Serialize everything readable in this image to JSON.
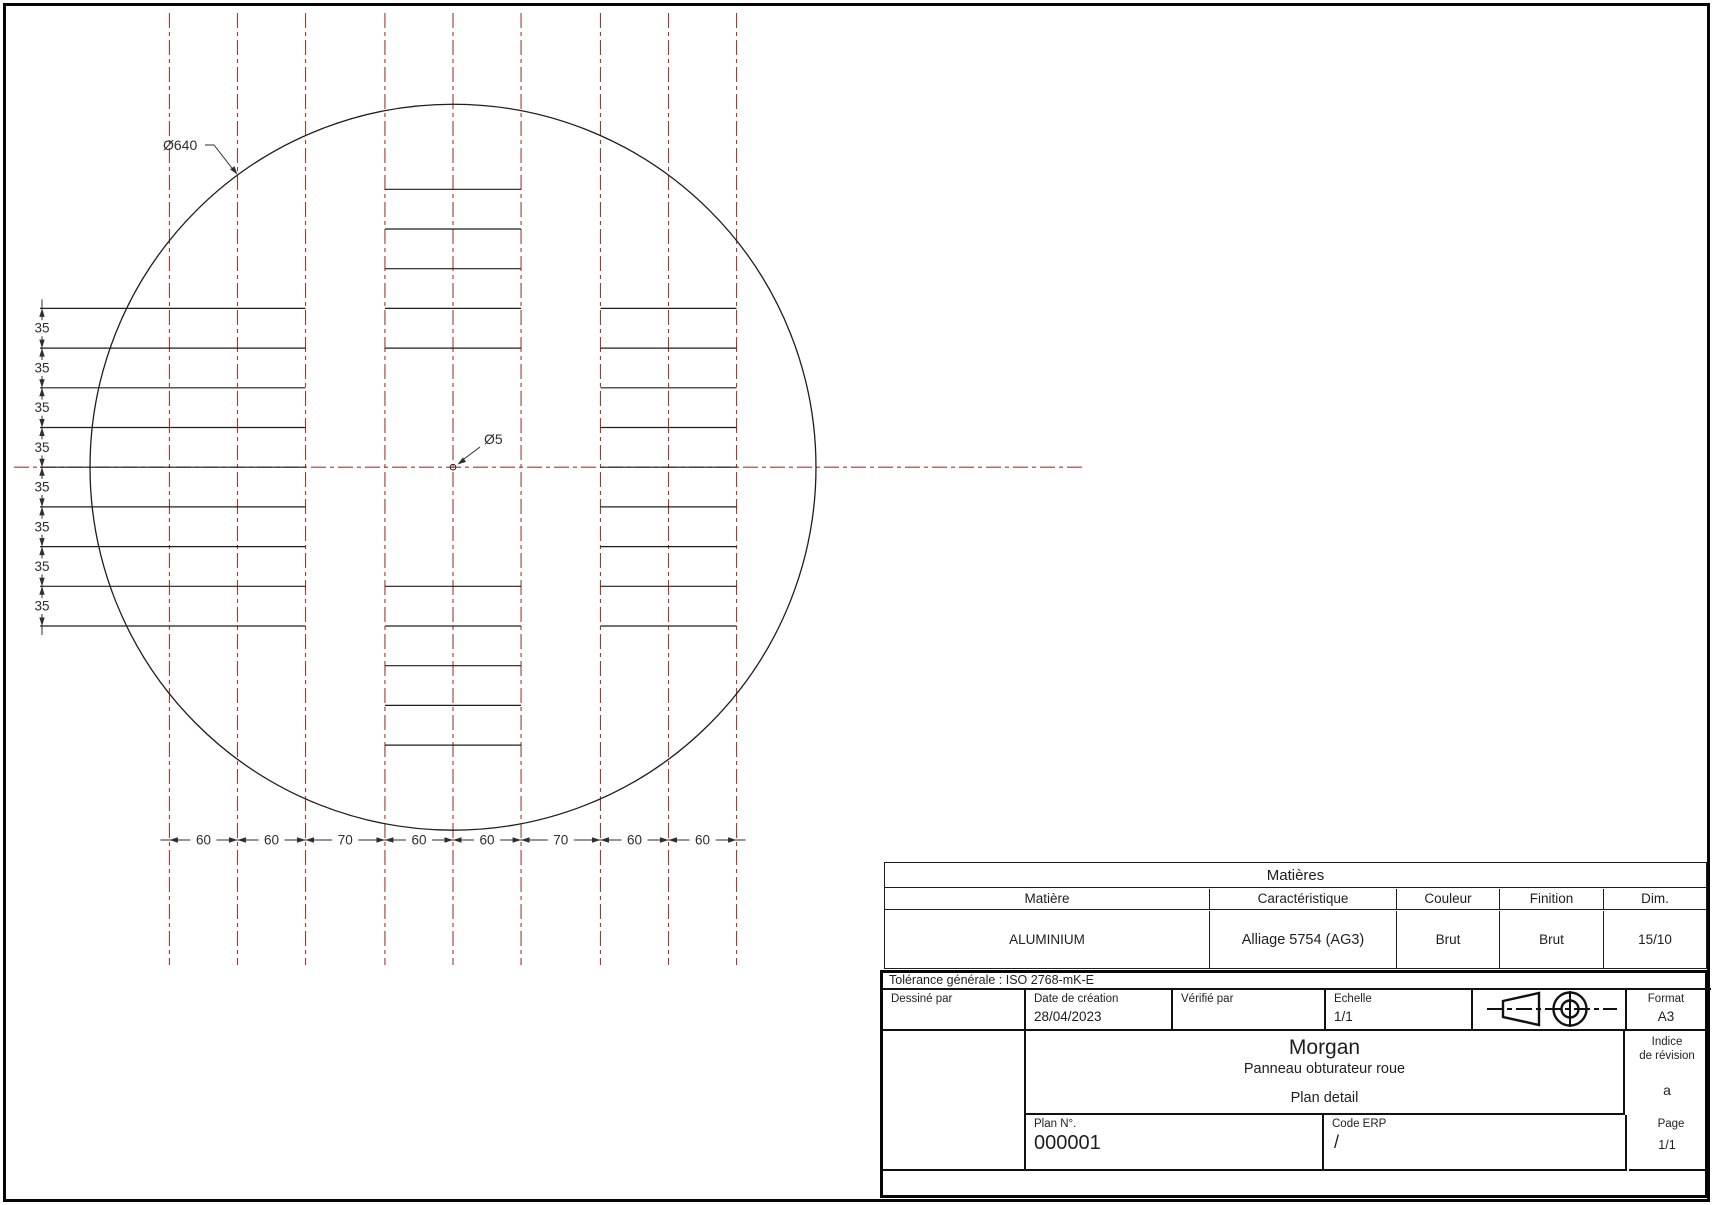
{
  "drawing": {
    "diameter_label": "Ø640",
    "center_hole_label": "Ø5",
    "diameter_mm": 640,
    "hole_diameter_mm": 5,
    "row_pitch_mm": 35,
    "row_dim_labels": [
      "35",
      "35",
      "35",
      "35",
      "35",
      "35",
      "35",
      "35"
    ],
    "column_dim_labels": [
      "60",
      "60",
      "70",
      "60",
      "60",
      "70",
      "60",
      "60"
    ],
    "column_dims_mm": [
      60,
      60,
      70,
      60,
      60,
      70,
      60,
      60
    ],
    "colors": {
      "centerline": "#a23a30",
      "line": "#1e1e1e",
      "dim": "#2e2e2e"
    }
  },
  "materials_table": {
    "title": "Matières",
    "headers": [
      "Matière",
      "Caractéristique",
      "Couleur",
      "Finition",
      "Dim."
    ],
    "row": [
      "ALUMINIUM",
      "Alliage 5754 (AG3)",
      "Brut",
      "Brut",
      "15/10"
    ]
  },
  "title_block": {
    "tolerance": "Tolérance générale : ISO 2768-mK-E",
    "drawn_by": {
      "label": "Dessiné par",
      "value": ""
    },
    "creation_date": {
      "label": "Date de création",
      "value": "28/04/2023"
    },
    "checked_by": {
      "label": "Vérifié par",
      "value": ""
    },
    "scale": {
      "label": "Echelle",
      "value": "1/1"
    },
    "format": {
      "label": "Format",
      "value": "A3"
    },
    "company": "Morgan",
    "part_title": "Panneau obturateur roue",
    "plan_type": "Plan detail",
    "revision": {
      "label_line1": "Indice",
      "label_line2": "de révision",
      "value": "a"
    },
    "plan_number": {
      "label": "Plan N°.",
      "value": "000001"
    },
    "erp_code": {
      "label": "Code ERP",
      "value": "/"
    },
    "page": {
      "label": "Page",
      "value": "1/1"
    }
  }
}
